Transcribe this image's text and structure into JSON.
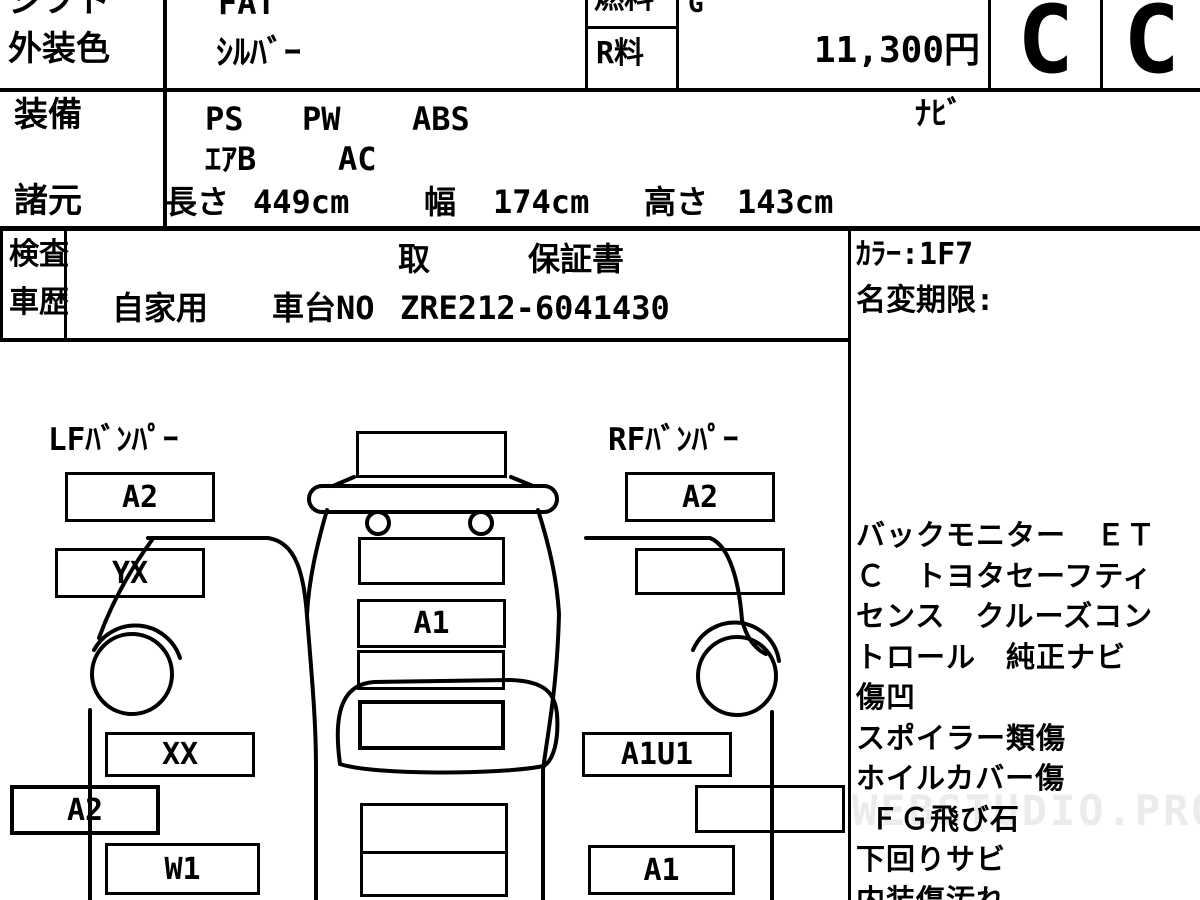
{
  "header": {
    "shift_label": "シフト",
    "shift_value": "FAT",
    "fuel_label": "燃料",
    "fuel_value": "G",
    "exterior_color_label": "外装色",
    "exterior_color_value": "ｼﾙﾊﾞｰ",
    "recycle_fee_label": "R料",
    "recycle_fee_value": "11,300円",
    "grade_exterior": "C",
    "grade_interior": "C"
  },
  "equipment": {
    "label": "装備",
    "item_ps": "PS",
    "item_pw": "PW",
    "item_abs": "ABS",
    "item_nav": "ﾅﾋﾞ",
    "item_airbag": "ｴｱB",
    "item_ac": "AC"
  },
  "specs": {
    "label": "諸元",
    "length_label": "長さ",
    "length_value": "449cm",
    "width_label": "幅",
    "width_value": "174cm",
    "height_label": "高さ",
    "height_value": "143cm"
  },
  "inspection": {
    "inspect_label": "検査",
    "history_label": "車歴",
    "docs_line": "取",
    "warranty_book": "保証書",
    "usage": "自家用",
    "chassis_label": "車台NO",
    "chassis_no": "ZRE212-6041430",
    "color_code": "ｶﾗｰ:1F7",
    "name_change_limit": "名変期限:"
  },
  "diagram": {
    "lf_bumper_label": "LFﾊﾞﾝﾊﾟｰ",
    "rf_bumper_label": "RFﾊﾞﾝﾊﾟｰ",
    "boxes": [
      {
        "area": "lf-bumper",
        "code": "A2"
      },
      {
        "area": "left-front-fender",
        "code": "YX"
      },
      {
        "area": "left-front-door",
        "code": "XX"
      },
      {
        "area": "left-side",
        "code": "A2"
      },
      {
        "area": "left-rear-door",
        "code": "W1"
      },
      {
        "area": "front-center-top",
        "code": ""
      },
      {
        "area": "front-grille",
        "code": ""
      },
      {
        "area": "hood",
        "code": "A1"
      },
      {
        "area": "cowl",
        "code": ""
      },
      {
        "area": "windshield",
        "code": ""
      },
      {
        "area": "roof",
        "code": ""
      },
      {
        "area": "rf-bumper",
        "code": "A2"
      },
      {
        "area": "right-front-fender",
        "code": ""
      },
      {
        "area": "right-front-door",
        "code": "A1U1"
      },
      {
        "area": "right-side",
        "code": ""
      },
      {
        "area": "right-rear-door",
        "code": "A1"
      }
    ]
  },
  "notes": {
    "lines": [
      "バックモニター　ＥＴ",
      "Ｃ　トヨタセーフティ",
      "センス　クルーズコン",
      "トロール　純正ナビ",
      "傷凹",
      "スポイラー類傷",
      "ホイルカバー傷",
      "ＦＧ飛び石",
      "下回りサビ",
      "内装傷汚れ"
    ]
  },
  "watermark": "WEBSTUDIO.PRO"
}
